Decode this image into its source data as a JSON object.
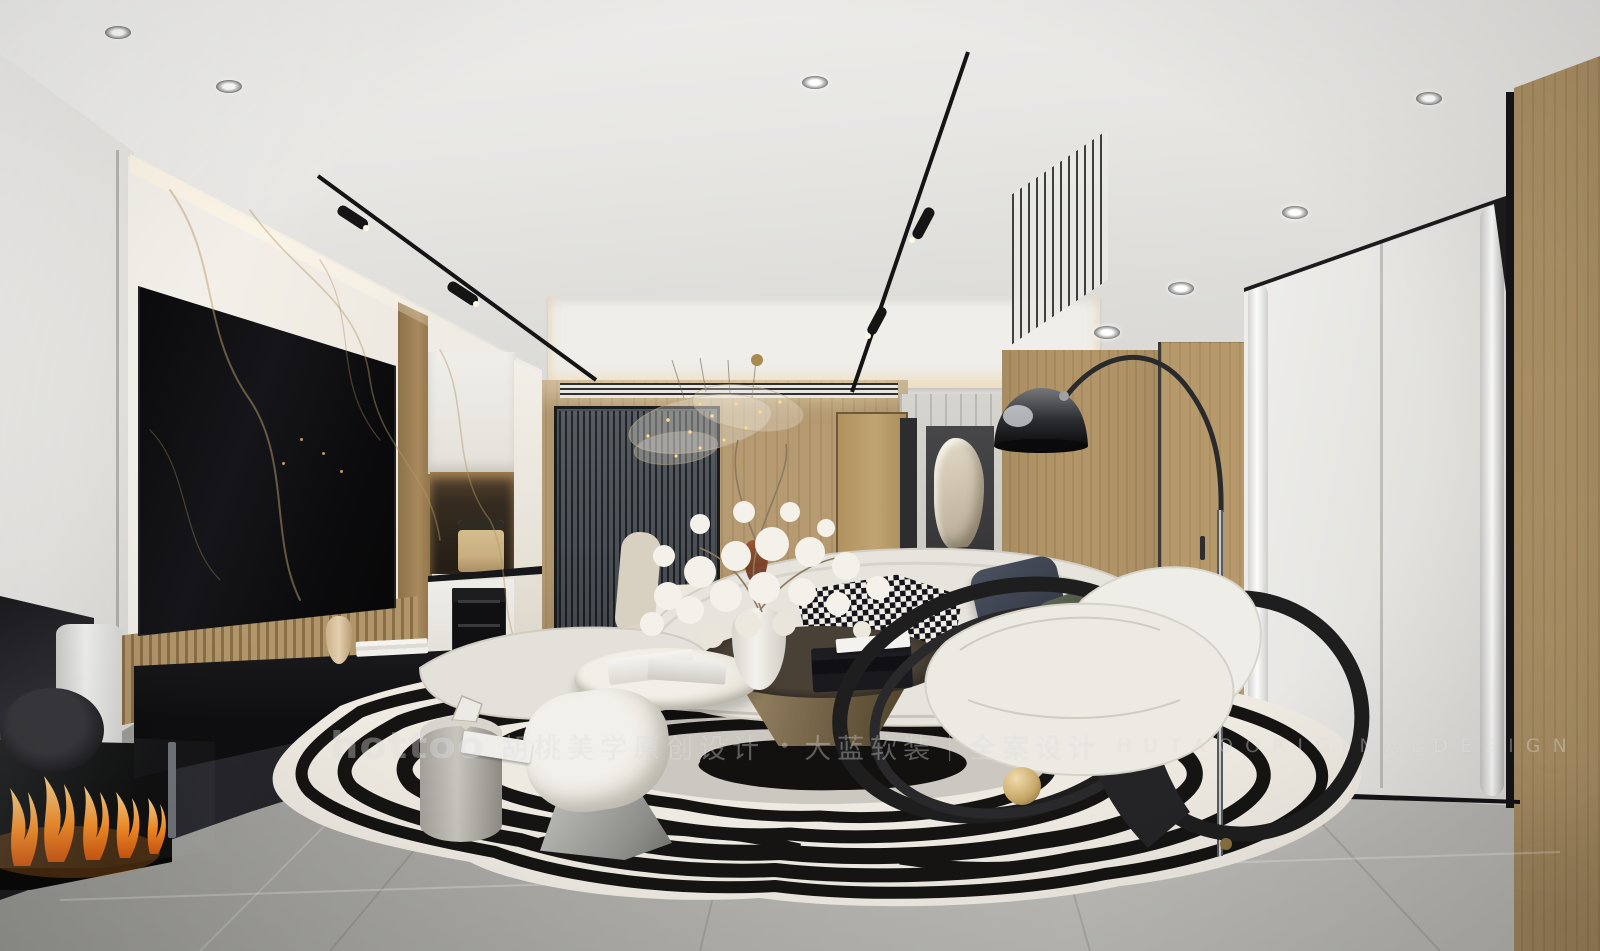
{
  "watermark": {
    "logo": "hottoo",
    "brand_cn": "胡桃美学原创设计",
    "dot": "•",
    "services_cn": "大蓝软装｜全案设计",
    "brand_en": "H U T A O   O R I G I N A L   D E S I G N"
  },
  "palette": {
    "ceiling": "#e9e8e5",
    "wood": "#b1956a",
    "marble_white": "#f3f0ea",
    "marble_vein": "#c3a87e",
    "floor_gray": "#b3b2ae",
    "sofa_cream": "#e7e4dd",
    "rug_black": "#151412",
    "rug_white": "#eee9e1",
    "bronze_table": "#7c6c52",
    "flame_orange": "#ff8e1f",
    "pillow_navy": "#434a57",
    "pillow_green": "#5a6351",
    "console_black": "#121214",
    "cove_warm": "#f2dcae"
  }
}
